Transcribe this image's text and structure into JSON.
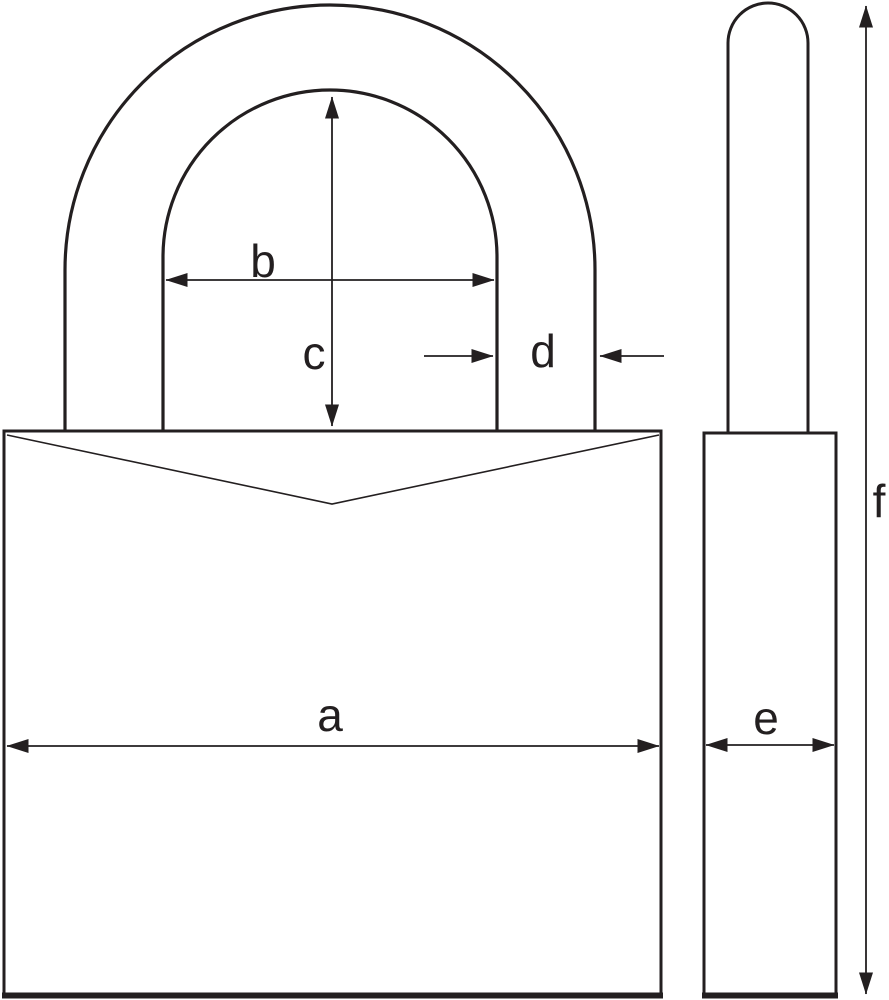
{
  "diagram": {
    "labels": {
      "a": "a",
      "b": "b",
      "c": "c",
      "d": "d",
      "e": "e",
      "f": "f"
    }
  },
  "colors": {
    "ink": "#231f20",
    "background": "#ffffff"
  }
}
